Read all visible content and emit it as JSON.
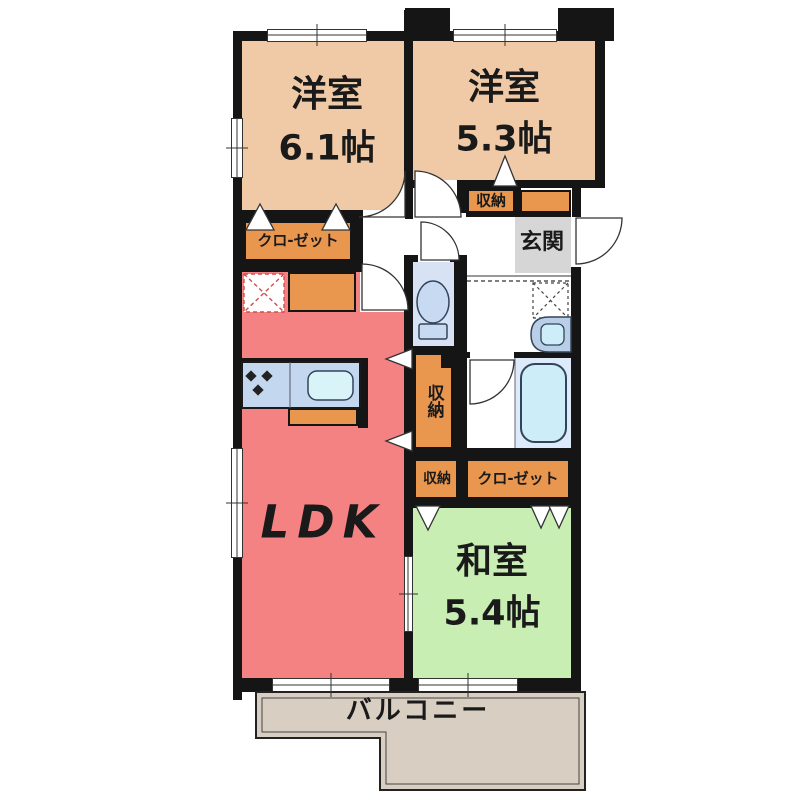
{
  "palette": {
    "wall": "#151515",
    "western_room": "#f0caa6",
    "accent_orange": "#e9964f",
    "ldk_red": "#f58282",
    "japanese_green": "#c9eeb4",
    "balcony_beige": "#d8cec2",
    "entrance_gray": "#d6d6d6",
    "wet_area_blue": "#d7e3f4",
    "bath_floor": "#dceafa",
    "fixture_blue": "#c8d9f2",
    "fixture_cyan": "#cdeef8",
    "counter_blue": "#c3d7ee",
    "fridge_dash_red": "#cf4f4c"
  },
  "rooms": {
    "western1": {
      "label": "洋室",
      "size": "6.1帖"
    },
    "western2": {
      "label": "洋室",
      "size": "5.3帖"
    },
    "ldk": {
      "label": "LDK"
    },
    "japanese": {
      "label": "和室",
      "size": "5.4帖"
    },
    "entrance": {
      "label": "玄関"
    },
    "balcony": {
      "label": "バルコニー"
    }
  },
  "storage": {
    "closet_west1": {
      "label": "クロ-ゼット"
    },
    "closet_japanese": {
      "label": "クロ-ゼット"
    },
    "shuno_hall": {
      "label": "収納"
    },
    "shuno_center": {
      "label": "収納"
    },
    "shuno_small": {
      "label": "収納"
    }
  },
  "fixtures": {
    "toilet": "toilet",
    "bathtub": "bathtub",
    "washbasin": "washbasin",
    "kitchen": "kitchen-counter-with-sink",
    "washer_space": "washing-machine-space",
    "fridge_space": "refrigerator-space"
  }
}
